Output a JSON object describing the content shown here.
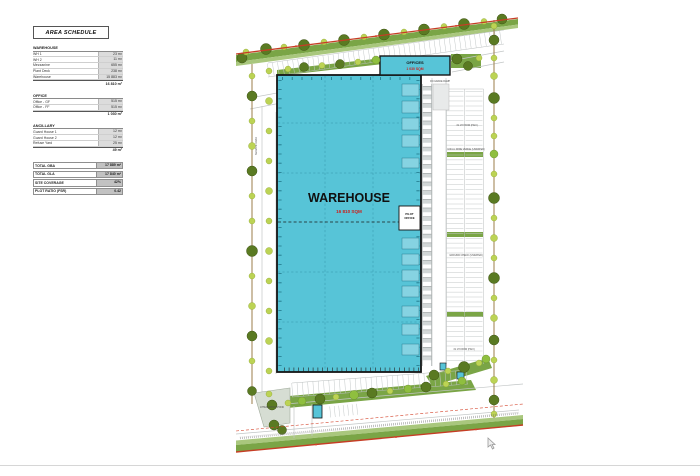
{
  "area_schedule": {
    "title": "AREA SCHEDULE",
    "sections": [
      {
        "header": "WAREHOUSE",
        "rows": [
          {
            "label": "WH 1",
            "value": "23 m²"
          },
          {
            "label": "WH 2",
            "value": "11 m²"
          },
          {
            "label": "Mezzanine",
            "value": "655 m²"
          },
          {
            "label": "Plant Deck",
            "value": "238 m²"
          },
          {
            "label": "Warehouse",
            "value": "15 883 m²"
          }
        ],
        "subtotal": "16 810 m²"
      },
      {
        "header": "OFFICE",
        "rows": [
          {
            "label": "Office - GF",
            "value": "515 m²"
          },
          {
            "label": "Office - FF",
            "value": "515 m²"
          }
        ],
        "subtotal": "1 030 m²"
      },
      {
        "header": "ANCILLARY",
        "rows": [
          {
            "label": "Guard House 1",
            "value": "12 m²"
          },
          {
            "label": "Guard House 2",
            "value": "12 m²"
          },
          {
            "label": "Refuse Yard",
            "value": "25 m²"
          }
        ],
        "subtotal": "49 m²"
      }
    ],
    "totals": [
      {
        "label": "TOTAL GBA",
        "value": "17 889 m²"
      },
      {
        "label": "TOTAL GLA",
        "value": "17 840 m²"
      },
      {
        "label": "SITE COVERAGE",
        "value": "42%"
      },
      {
        "label": "PLOT RATIO (FSR)",
        "value": "0.42"
      }
    ]
  },
  "plan": {
    "warehouse_label": "WAREHOUSE",
    "warehouse_area": "16 810 SQM",
    "offices_label": "OFFICES",
    "offices_area": "1 030 SQM",
    "pilot_office_line1": "PILOT",
    "pilot_office_line2": "OFFICE",
    "pond_label": "ATTENUATION POND",
    "annotations": {
      "ramp": "ON GRADE RAMP",
      "row_top": "31 170 ROW (HGV)",
      "verge_note": "100mm WIDE VERGE (UNRATED)",
      "check": "GROUND CHECK (UNRATED)",
      "row_bottom": "31 170 ROW (HGV)",
      "road": "SERVICE ROAD"
    },
    "colors": {
      "building": "#57c4d7",
      "boundary_red": "#c63d25",
      "tree_dark": "#5a7a22",
      "tree_light": "#bcd354",
      "verge_green": "#7aa546"
    }
  }
}
